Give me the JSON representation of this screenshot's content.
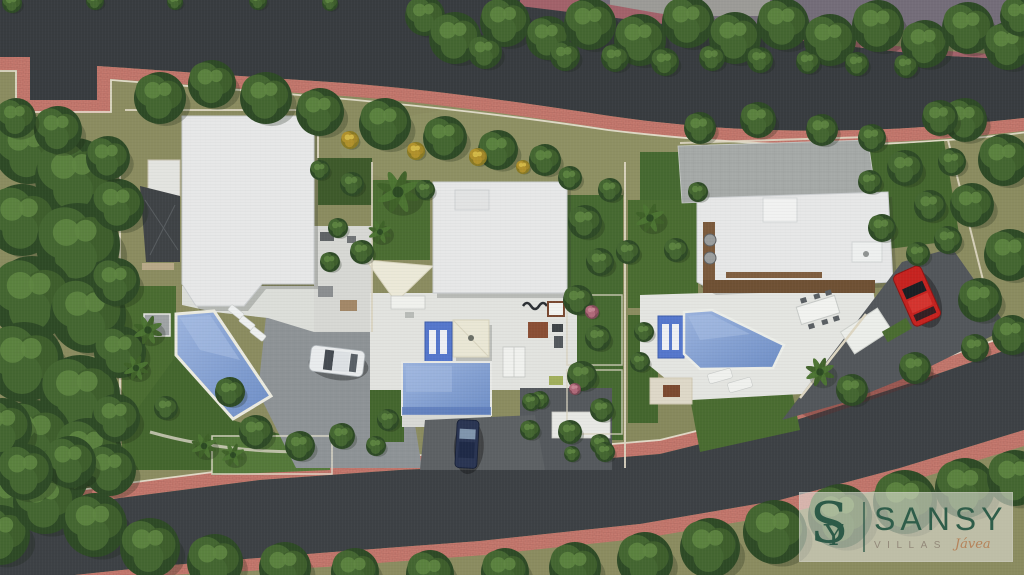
{
  "image": {
    "type": "architectural-aerial-render",
    "description": "Top-down 3D render of a three-villa development with pools, gardens, driveways, tree-lined roads and pink sidewalks",
    "width": 1024,
    "height": 575
  },
  "watermark": {
    "monogram": "S",
    "monogram_overlay": "Y",
    "brand": "SANSY",
    "series": "VILLAS",
    "location": "Jávea"
  },
  "colors": {
    "asphalt_top": "#383c40",
    "asphalt_bottom": "#3d4145",
    "sidewalk_pink": "#c5796e",
    "ground_olive": "#8b8c60",
    "lawn_green": "#4a6c31",
    "roof_white": "#e7e8e8",
    "paver_gray": "#a6aaa8",
    "pool_blue": "#7d9bd0",
    "mosaic_blue": "#5577cc",
    "deck_wood": "#6f5134",
    "canopy_cream": "#eae7d5",
    "car_white": "#e9eced",
    "car_navy": "#2a3553",
    "car_red": "#c62320",
    "logo_green": "#2d5a48",
    "logo_tan": "#b5835a"
  },
  "scene": {
    "villas": 3,
    "pools": 3,
    "cars": [
      "white-car",
      "navy-car",
      "red-car"
    ],
    "trees": [
      [
        425,
        16,
        20
      ],
      [
        455,
        38,
        26
      ],
      [
        505,
        22,
        25
      ],
      [
        548,
        38,
        22
      ],
      [
        590,
        24,
        26
      ],
      [
        640,
        40,
        26
      ],
      [
        688,
        22,
        26
      ],
      [
        735,
        38,
        26
      ],
      [
        783,
        24,
        26
      ],
      [
        830,
        40,
        26
      ],
      [
        878,
        26,
        26
      ],
      [
        925,
        44,
        24
      ],
      [
        968,
        28,
        26
      ],
      [
        1008,
        46,
        24
      ],
      [
        1020,
        16,
        20
      ],
      [
        485,
        52,
        17
      ],
      [
        565,
        56,
        15
      ],
      [
        615,
        58,
        14
      ],
      [
        665,
        62,
        14
      ],
      [
        712,
        58,
        13
      ],
      [
        760,
        60,
        13
      ],
      [
        808,
        62,
        12
      ],
      [
        857,
        64,
        12
      ],
      [
        906,
        66,
        12
      ],
      [
        12,
        3,
        10
      ],
      [
        95,
        1,
        9
      ],
      [
        175,
        2,
        8
      ],
      [
        258,
        1,
        9
      ],
      [
        330,
        3,
        8
      ],
      [
        28,
        150,
        34
      ],
      [
        75,
        178,
        40
      ],
      [
        22,
        220,
        36
      ],
      [
        78,
        245,
        42
      ],
      [
        32,
        298,
        42
      ],
      [
        88,
        315,
        38
      ],
      [
        24,
        362,
        40
      ],
      [
        80,
        395,
        40
      ],
      [
        34,
        438,
        38
      ],
      [
        88,
        452,
        34
      ],
      [
        118,
        205,
        26
      ],
      [
        116,
        282,
        24
      ],
      [
        120,
        352,
        26
      ],
      [
        116,
        418,
        24
      ],
      [
        58,
        478,
        30
      ],
      [
        14,
        498,
        28
      ],
      [
        2,
        428,
        30
      ],
      [
        108,
        158,
        22
      ],
      [
        58,
        130,
        24
      ],
      [
        16,
        118,
        20
      ],
      [
        110,
        470,
        26
      ],
      [
        160,
        98,
        26
      ],
      [
        212,
        84,
        24
      ],
      [
        266,
        98,
        26
      ],
      [
        320,
        112,
        24
      ],
      [
        385,
        124,
        26
      ],
      [
        445,
        138,
        22
      ],
      [
        498,
        150,
        20
      ],
      [
        545,
        160,
        16
      ],
      [
        398,
        192,
        22,
        1
      ],
      [
        350,
        140,
        9,
        2
      ],
      [
        416,
        151,
        9,
        2
      ],
      [
        478,
        157,
        9,
        2
      ],
      [
        523,
        167,
        7,
        2
      ],
      [
        700,
        128,
        16
      ],
      [
        758,
        120,
        18
      ],
      [
        822,
        130,
        16
      ],
      [
        872,
        138,
        14
      ],
      [
        148,
        330,
        15,
        1
      ],
      [
        136,
        368,
        13,
        1
      ],
      [
        230,
        392,
        15
      ],
      [
        256,
        432,
        17
      ],
      [
        300,
        446,
        15
      ],
      [
        204,
        446,
        13,
        1
      ],
      [
        166,
        408,
        12
      ],
      [
        342,
        436,
        13
      ],
      [
        320,
        170,
        10
      ],
      [
        352,
        184,
        12
      ],
      [
        338,
        228,
        10
      ],
      [
        362,
        252,
        12
      ],
      [
        330,
        262,
        10
      ],
      [
        233,
        455,
        12,
        1
      ],
      [
        585,
        222,
        17
      ],
      [
        600,
        262,
        14
      ],
      [
        578,
        300,
        15
      ],
      [
        598,
        338,
        13
      ],
      [
        582,
        376,
        15
      ],
      [
        602,
        410,
        12
      ],
      [
        570,
        432,
        12
      ],
      [
        628,
        252,
        12
      ],
      [
        592,
        312,
        7,
        3
      ],
      [
        610,
        190,
        12
      ],
      [
        570,
        178,
        12
      ],
      [
        380,
        232,
        12,
        1
      ],
      [
        425,
        190,
        10
      ],
      [
        388,
        420,
        11
      ],
      [
        376,
        446,
        10
      ],
      [
        540,
        400,
        9
      ],
      [
        530,
        430,
        10
      ],
      [
        600,
        444,
        10
      ],
      [
        575,
        389,
        6,
        3
      ],
      [
        531,
        402,
        9
      ],
      [
        650,
        218,
        15,
        1
      ],
      [
        676,
        250,
        12
      ],
      [
        644,
        332,
        10
      ],
      [
        640,
        362,
        10
      ],
      [
        698,
        192,
        10
      ],
      [
        905,
        168,
        18
      ],
      [
        930,
        206,
        16
      ],
      [
        882,
        228,
        14
      ],
      [
        948,
        240,
        14
      ],
      [
        918,
        254,
        12
      ],
      [
        870,
        182,
        12
      ],
      [
        952,
        162,
        14
      ],
      [
        820,
        372,
        15,
        1
      ],
      [
        605,
        452,
        10
      ],
      [
        572,
        454,
        8
      ],
      [
        965,
        120,
        22
      ],
      [
        1004,
        160,
        26
      ],
      [
        972,
        205,
        22
      ],
      [
        1010,
        255,
        26
      ],
      [
        980,
        300,
        22
      ],
      [
        1012,
        335,
        20
      ],
      [
        940,
        118,
        18
      ],
      [
        852,
        390,
        16
      ],
      [
        915,
        368,
        16
      ],
      [
        975,
        348,
        14
      ],
      [
        0,
        535,
        30
      ],
      [
        45,
        502,
        32
      ],
      [
        95,
        525,
        32
      ],
      [
        150,
        548,
        30
      ],
      [
        215,
        562,
        28
      ],
      [
        285,
        568,
        26
      ],
      [
        355,
        572,
        24
      ],
      [
        430,
        574,
        24
      ],
      [
        505,
        572,
        24
      ],
      [
        575,
        568,
        26
      ],
      [
        645,
        560,
        28
      ],
      [
        710,
        548,
        30
      ],
      [
        775,
        532,
        32
      ],
      [
        840,
        516,
        32
      ],
      [
        905,
        502,
        32
      ],
      [
        965,
        488,
        30
      ],
      [
        1015,
        478,
        28
      ],
      [
        70,
        462,
        26
      ],
      [
        25,
        472,
        28
      ]
    ]
  }
}
